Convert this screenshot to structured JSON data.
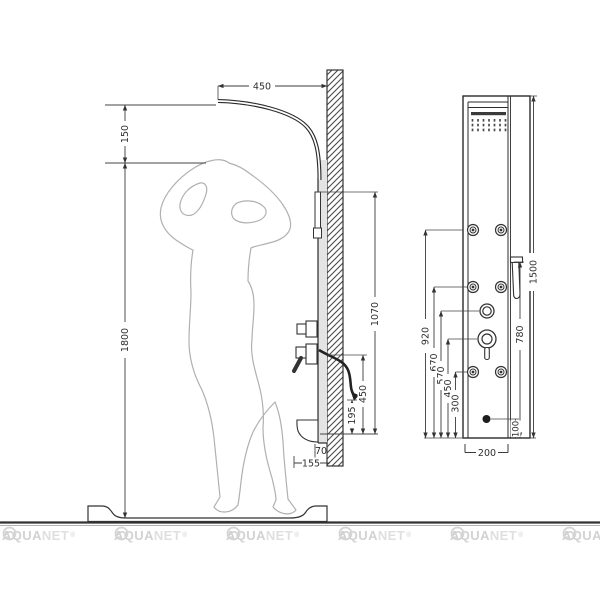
{
  "side_view": {
    "dim_arm_projection": "450",
    "dim_head_offset": "150",
    "dim_figure_height": "1800",
    "dim_hand_shower_height": "1070",
    "dim_spout_height": "450",
    "dim_hose_end_height": "195",
    "dim_panel_depth": "70",
    "dim_shelf_depth": "155"
  },
  "front_view": {
    "dim_total_height": "1500",
    "dim_jets_top": "920",
    "dim_jets_middle": "670",
    "dim_diverter_height": "570",
    "dim_mixer_height": "450",
    "dim_jets_bottom": "300",
    "dim_hand_shower_holder": "780",
    "dim_outlet_height": "100",
    "dim_panel_width": "200"
  },
  "watermark": {
    "bold": "AQUA",
    "light": "NET",
    "reg": "®"
  }
}
